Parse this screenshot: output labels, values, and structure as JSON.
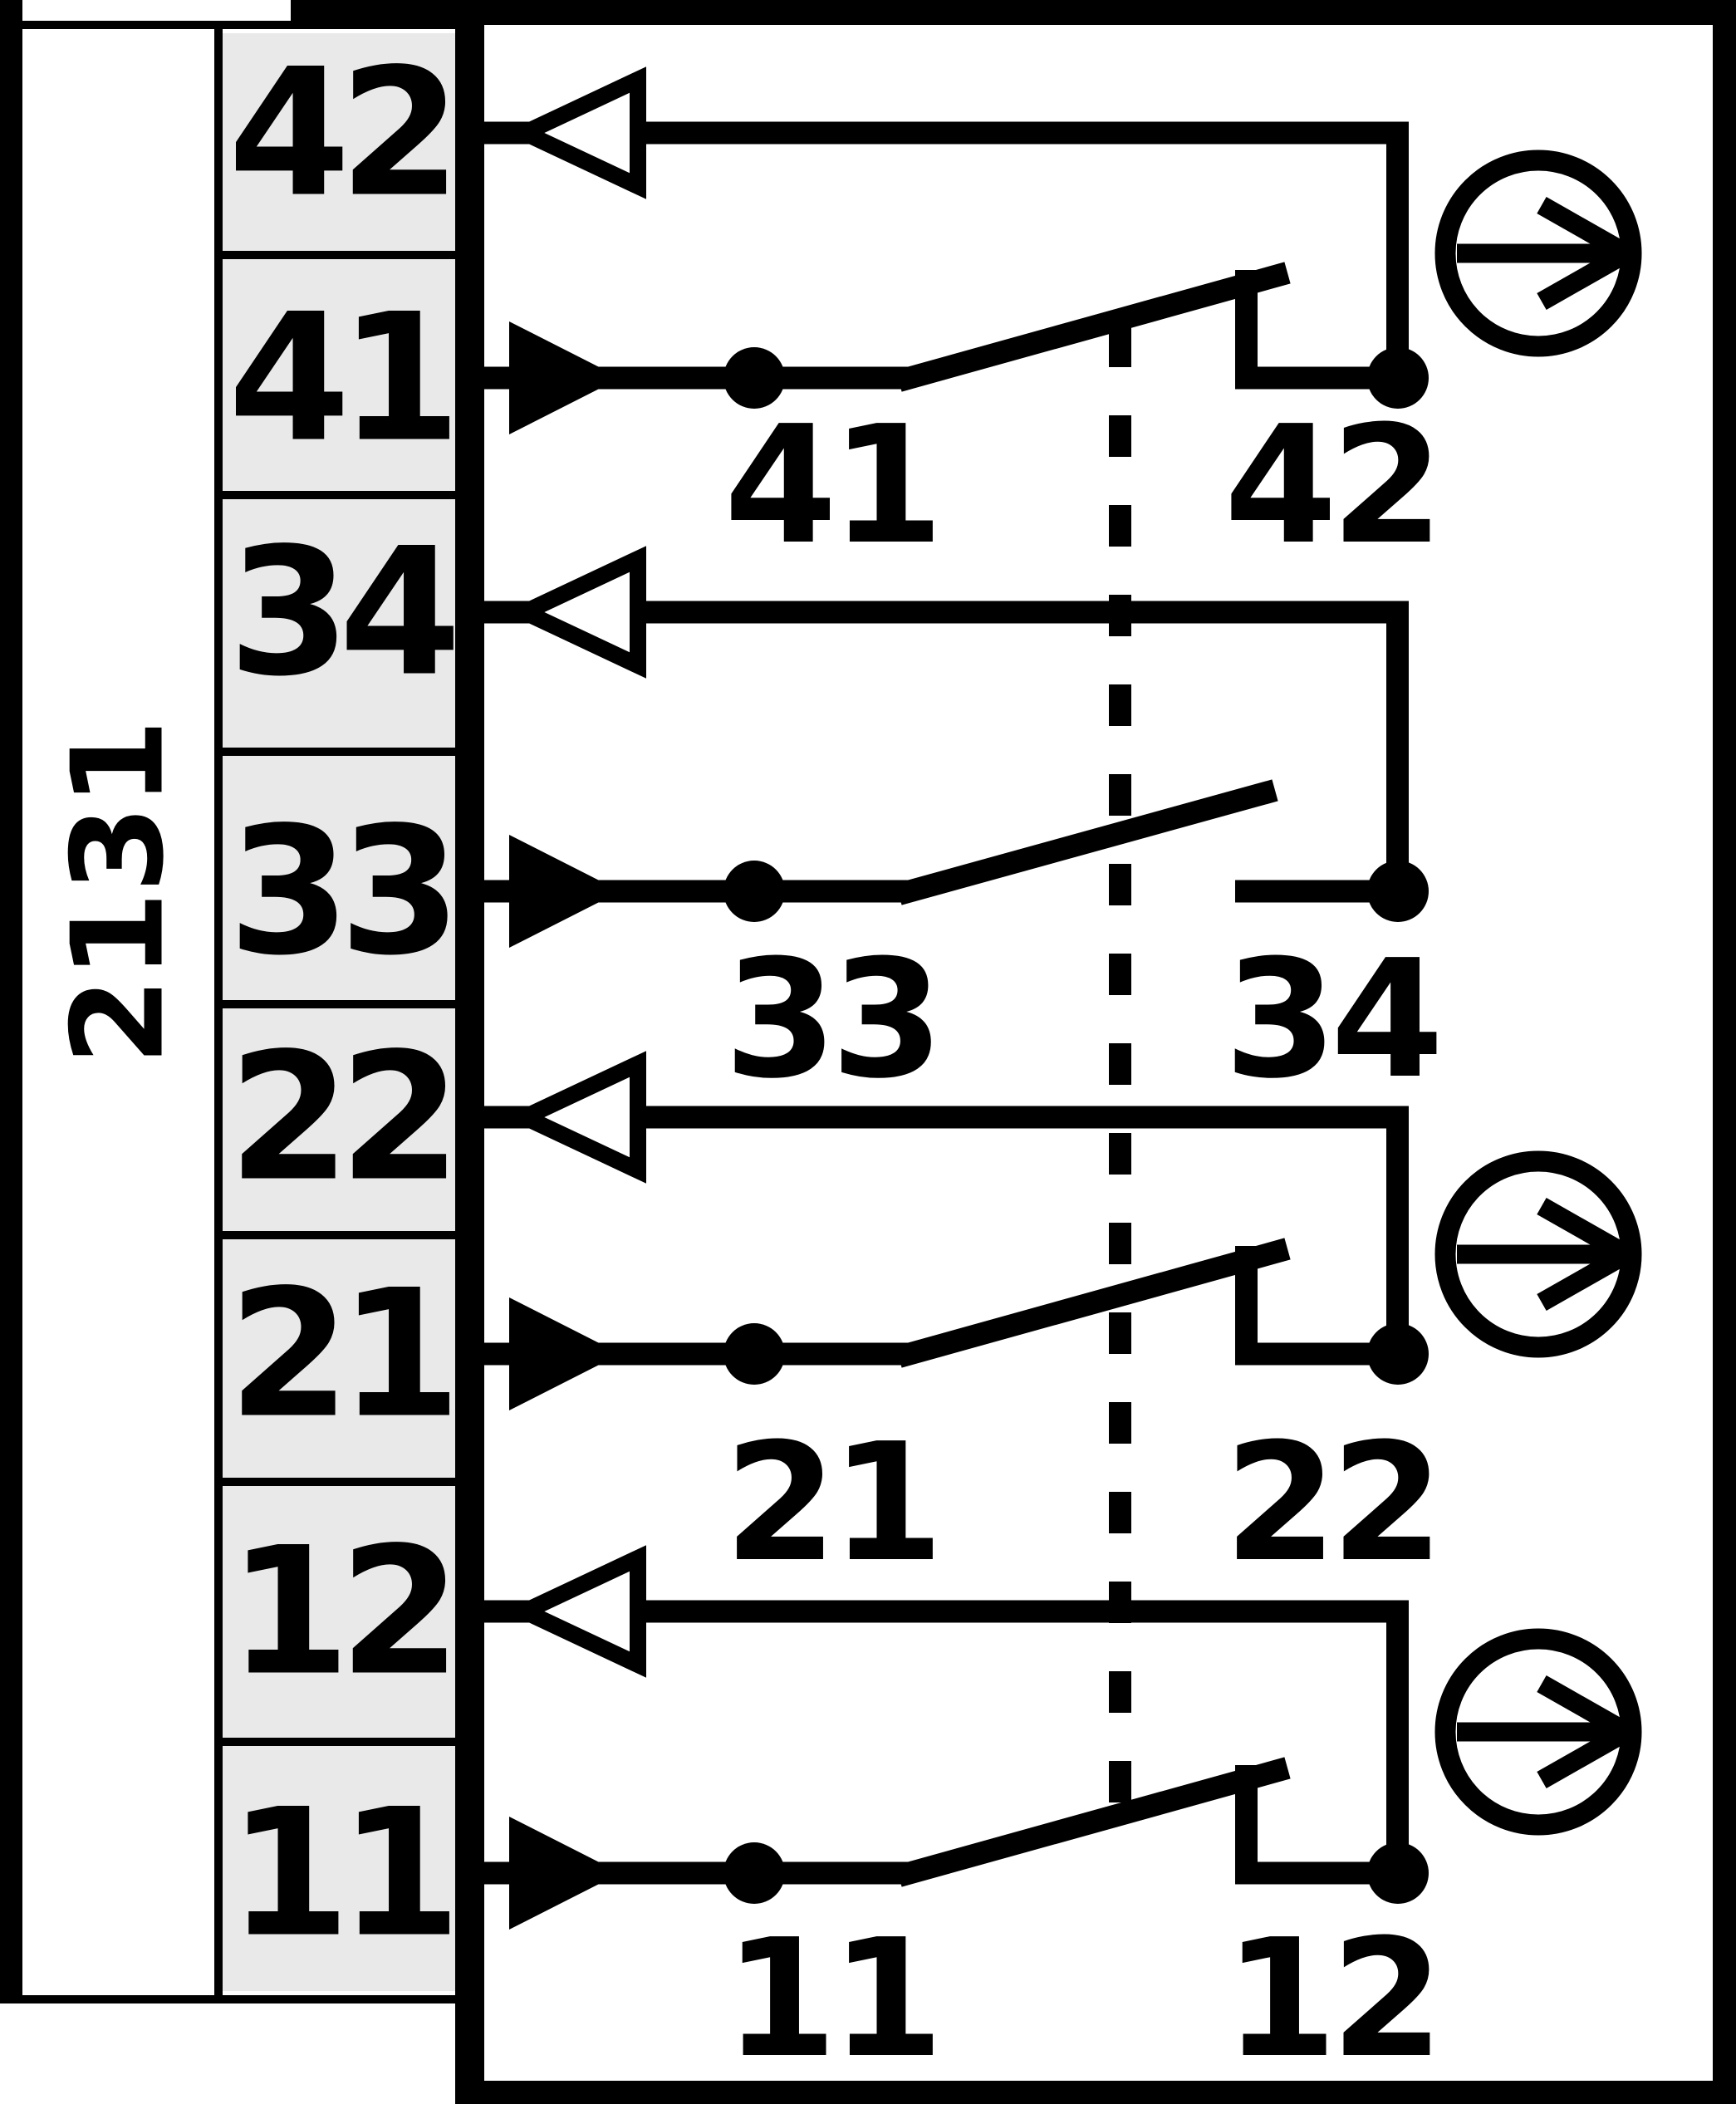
{
  "diagram_code": "2131",
  "terminal_strip": {
    "terminals": [
      "42",
      "41",
      "34",
      "33",
      "22",
      "21",
      "12",
      "11"
    ]
  },
  "contact_pairs": [
    {
      "type": "nc-break-positive-opening",
      "moving_label": "41",
      "fixed_label": "42",
      "has_actuator_icon": true
    },
    {
      "type": "no-make",
      "moving_label": "33",
      "fixed_label": "34",
      "has_actuator_icon": false
    },
    {
      "type": "nc-break-positive-opening",
      "moving_label": "21",
      "fixed_label": "22",
      "has_actuator_icon": true
    },
    {
      "type": "nc-break-positive-opening",
      "moving_label": "11",
      "fixed_label": "12",
      "has_actuator_icon": true
    }
  ],
  "icons": {
    "filled_arrow": "direction-arrow-filled-right",
    "open_arrow": "direction-arrow-open-left",
    "circle_arrow": "actuation-direction-circle-arrow",
    "dashed_line": "mechanical-linkage"
  },
  "colors": {
    "line": "#000000",
    "terminal_box_fill": "#e9e9e9",
    "background": "#ffffff"
  }
}
